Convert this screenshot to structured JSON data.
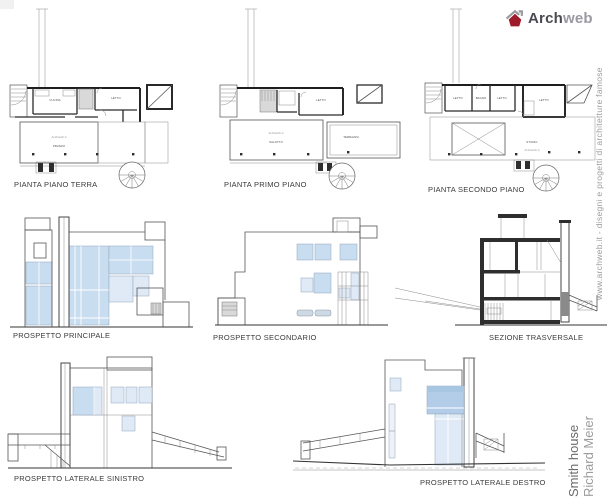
{
  "logo": {
    "part1": "Arch",
    "part2": "web",
    "icon": "house-icon"
  },
  "sidebar": {
    "url_caption": "www.archweb.it - disegni e progetti di architetture famose",
    "title": "Smith house",
    "architect": "Richard Meier"
  },
  "captions": {
    "plan_ground": "PIANTA PIANO TERRA",
    "plan_first": "PIANTA PRIMO PIANO",
    "plan_second": "PIANTA SECONDO PIANO",
    "elev_main": "PROSPETTO PRINCIPALE",
    "elev_secondary": "PROSPETTO SECONDARIO",
    "section": "SEZIONE TRASVERSALE",
    "elev_left": "PROSPETTO LATERALE SINISTRO",
    "elev_right": "PROSPETTO LATERALE DESTRO"
  },
  "room_labels": {
    "plan_ground": {
      "cucina": "CUCINA",
      "letto": "LETTO",
      "watermark": "Archweb.it",
      "pranzo": "PRANZO"
    },
    "plan_first": {
      "letto": "LETTO",
      "watermark": "Archweb.it",
      "salotto": "SALOTTO",
      "terrazza": "TERRAZZA"
    },
    "plan_second": {
      "letto1": "LETTO",
      "bagno": "BAGNO",
      "letto2": "LETTO",
      "letto3": "LETTO",
      "studio": "STUDIO",
      "watermark": "Archweb.it"
    }
  },
  "colors": {
    "glazing": "#c9ddf0",
    "glazing_light": "#dfeaf6",
    "accent_red": "#9e1b2c",
    "line_gray": "#9a9a9a",
    "caption_text": "#3a3a3a"
  }
}
